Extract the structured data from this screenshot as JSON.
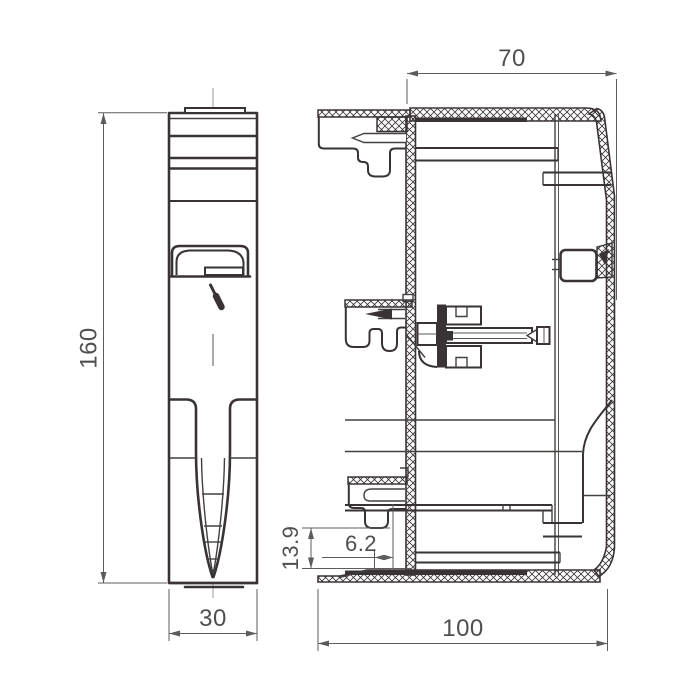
{
  "drawing": {
    "dim_height": "160",
    "dim_width": "30",
    "dim_top_depth": "70",
    "dim_bottom_depth": "100",
    "dim_hook_gap": "6.2",
    "dim_hook_height": "13.9"
  },
  "colors": {
    "line": "#3a3335",
    "dimension": "#5c5c5c",
    "background": "#ffffff"
  }
}
